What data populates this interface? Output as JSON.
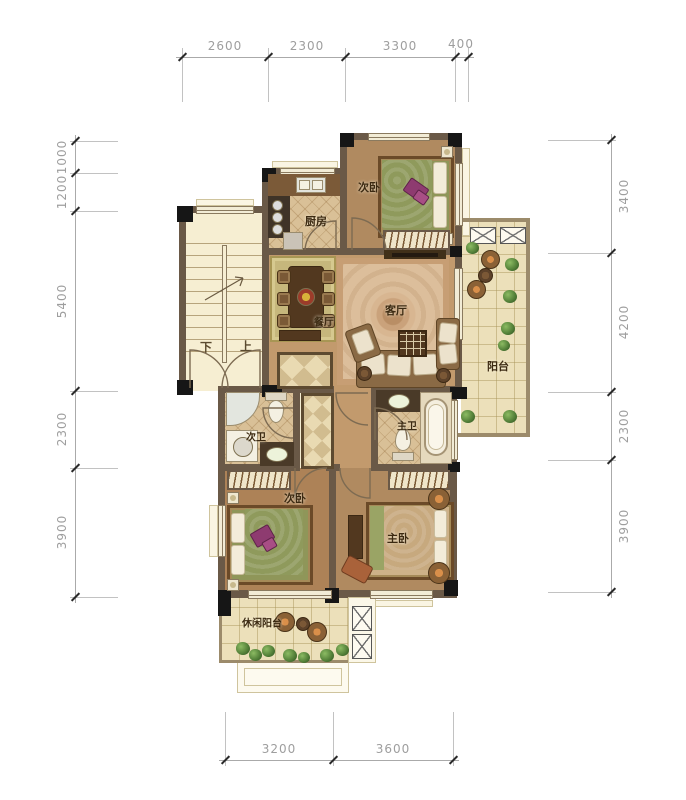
{
  "plan": {
    "rooms": {
      "bedroom_top": "次卧",
      "kitchen": "厨房",
      "dining": "餐厅",
      "living": "客厅",
      "balcony": "阳台",
      "bath_secondary": "次卫",
      "bath_master": "主卫",
      "bedroom_second": "次卧",
      "bedroom_master": "主卧",
      "balcony_leisure": "休闲阳台"
    },
    "stairs": {
      "down": "下",
      "up": "上"
    },
    "dimensions": {
      "top": [
        "2600",
        "2300",
        "3300",
        "400"
      ],
      "left": [
        "1000",
        "1200",
        "5400",
        "2300",
        "3900"
      ],
      "right": [
        "3400",
        "4200",
        "2300",
        "3900"
      ],
      "bottom": [
        "3200",
        "3600"
      ]
    },
    "colors": {
      "wall": "#6a5947",
      "column": "#161616",
      "wood_floor": "#c29a6d",
      "tile_floor": "#d9c097",
      "balcony_tile": "#ece0ba",
      "dimension_text": "#9e9e9e",
      "label_text": "#3c2a12"
    }
  }
}
